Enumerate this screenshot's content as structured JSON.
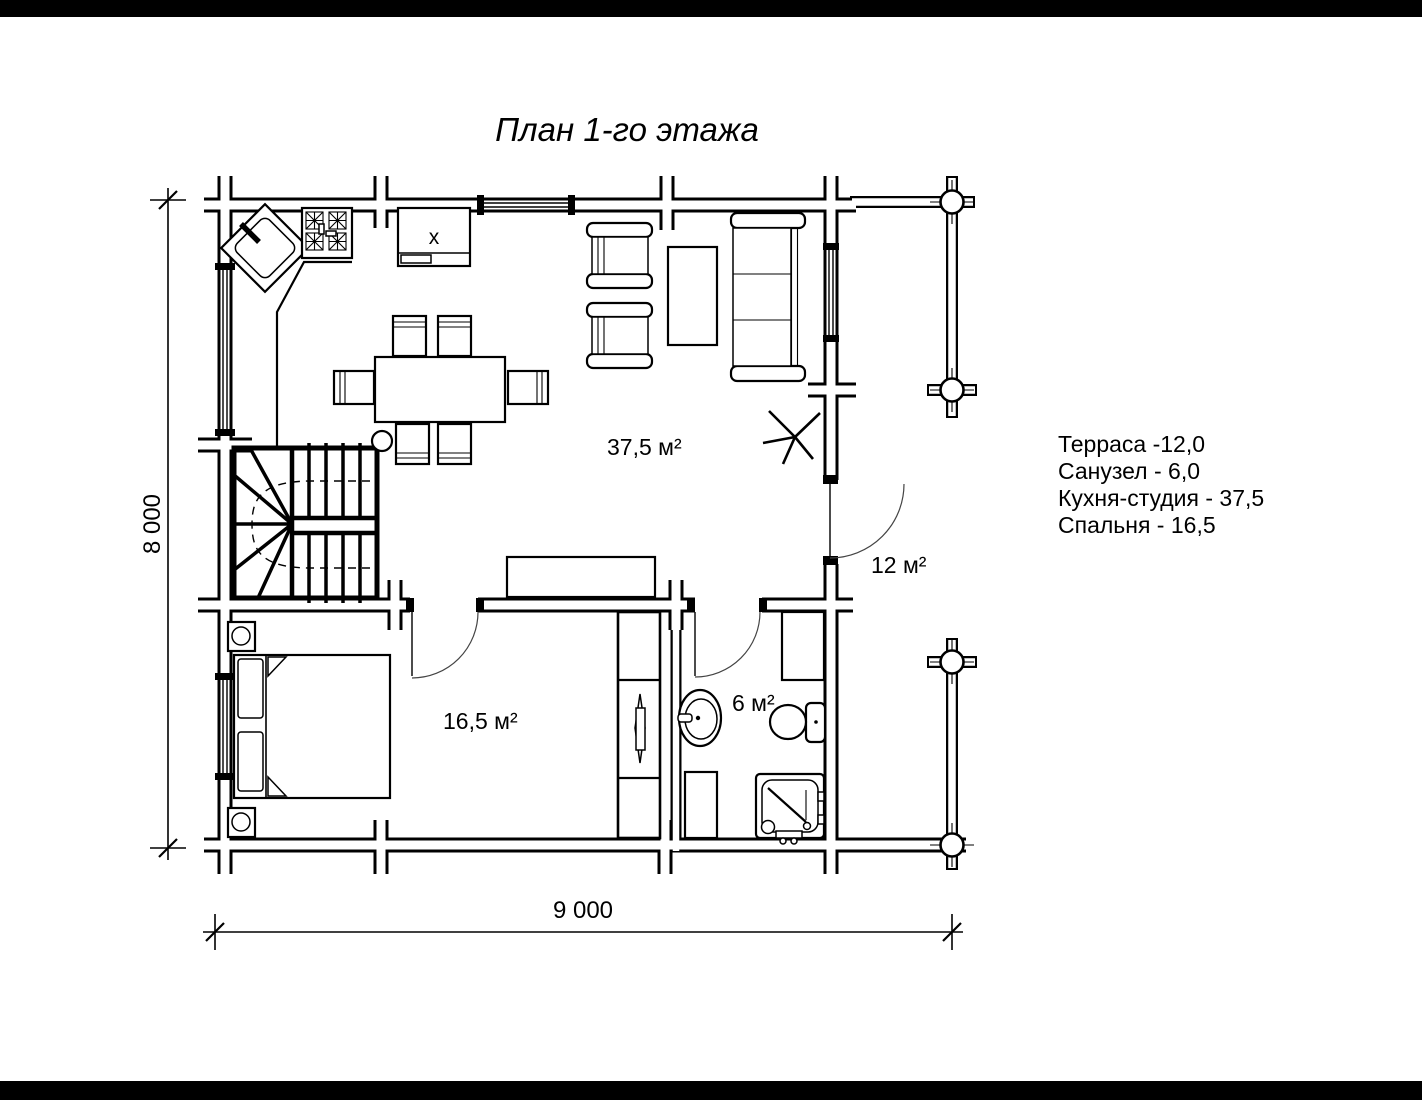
{
  "page": {
    "background": "#ffffff",
    "letterbox_color": "#000000",
    "ink": "#000000"
  },
  "title": "План 1-го этажа",
  "legend": {
    "items": [
      {
        "label": "Терраса -12,0"
      },
      {
        "label": "Санузел - 6,0"
      },
      {
        "label": "Кухня-студия - 37,5"
      },
      {
        "label": "Спальня - 16,5"
      }
    ]
  },
  "rooms": {
    "kitchen_studio": {
      "area_label": "37,5 м²"
    },
    "terrace": {
      "area_label": "12 м²"
    },
    "bedroom": {
      "area_label": "16,5 м²"
    },
    "bathroom": {
      "area_label": "6 м²"
    }
  },
  "dimensions": {
    "horizontal": "9 000",
    "vertical": "8 000"
  },
  "symbols": {
    "appliance_mark": "x"
  }
}
